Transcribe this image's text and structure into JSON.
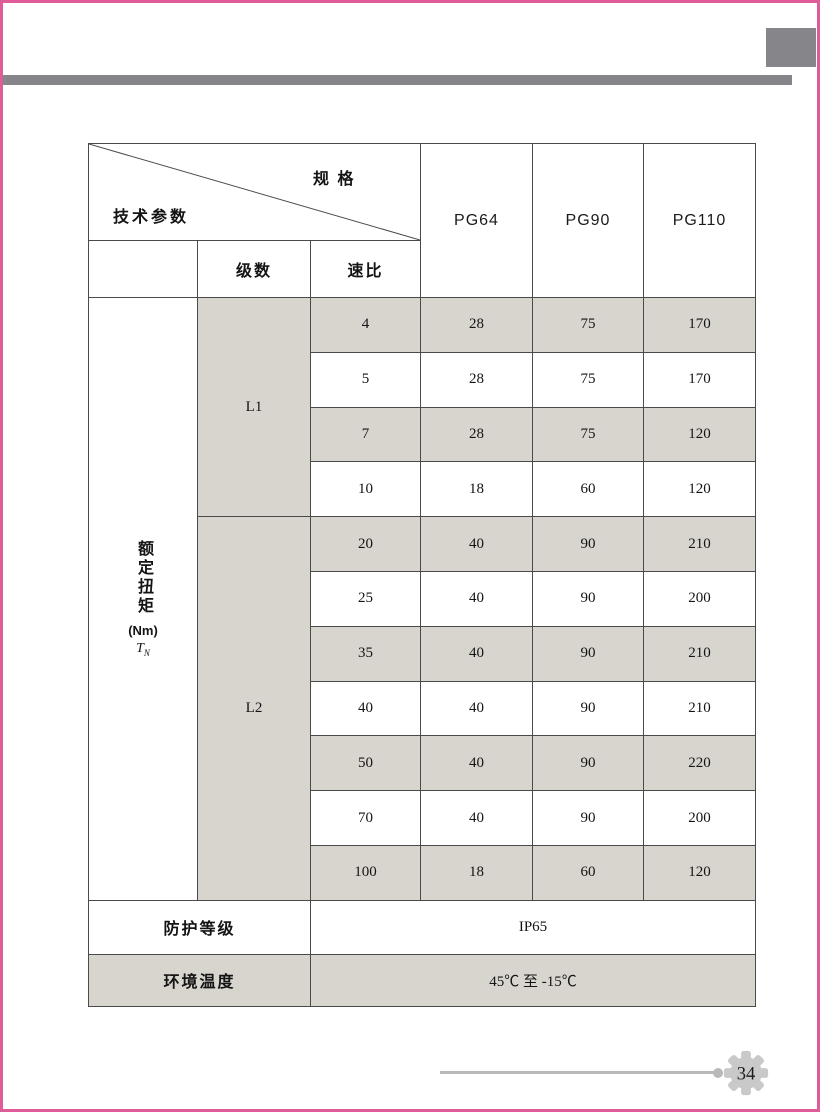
{
  "page": {
    "number": "34",
    "accent_color": "#e05c99",
    "bar_color": "#85858a",
    "shade_color": "#d8d5cf"
  },
  "table": {
    "corner": {
      "spec_label": "规 格",
      "params_label": "技术参数"
    },
    "col_headers": [
      "PG64",
      "PG90",
      "PG110"
    ],
    "sub_headers": {
      "stages": "级数",
      "ratio": "速比"
    },
    "row_label": {
      "vertical": "额定扭矩",
      "unit": "(Nm)",
      "symbol": "T",
      "symbol_sub": "N"
    },
    "groups": [
      {
        "label": "L1",
        "row_count": 4
      },
      {
        "label": "L2",
        "row_count": 7
      }
    ],
    "rows": [
      {
        "group": "L1",
        "ratio": "4",
        "pg64": "28",
        "pg90": "75",
        "pg110": "170"
      },
      {
        "group": "L1",
        "ratio": "5",
        "pg64": "28",
        "pg90": "75",
        "pg110": "170"
      },
      {
        "group": "L1",
        "ratio": "7",
        "pg64": "28",
        "pg90": "75",
        "pg110": "120"
      },
      {
        "group": "L1",
        "ratio": "10",
        "pg64": "18",
        "pg90": "60",
        "pg110": "120"
      },
      {
        "group": "L2",
        "ratio": "20",
        "pg64": "40",
        "pg90": "90",
        "pg110": "210"
      },
      {
        "group": "L2",
        "ratio": "25",
        "pg64": "40",
        "pg90": "90",
        "pg110": "200"
      },
      {
        "group": "L2",
        "ratio": "35",
        "pg64": "40",
        "pg90": "90",
        "pg110": "210"
      },
      {
        "group": "L2",
        "ratio": "40",
        "pg64": "40",
        "pg90": "90",
        "pg110": "210"
      },
      {
        "group": "L2",
        "ratio": "50",
        "pg64": "40",
        "pg90": "90",
        "pg110": "220"
      },
      {
        "group": "L2",
        "ratio": "70",
        "pg64": "40",
        "pg90": "90",
        "pg110": "200"
      },
      {
        "group": "L2",
        "ratio": "100",
        "pg64": "18",
        "pg90": "60",
        "pg110": "120"
      }
    ],
    "footer_rows": [
      {
        "label": "防护等级",
        "value": "IP65"
      },
      {
        "label": "环境温度",
        "value": "45℃ 至 -15℃"
      }
    ]
  }
}
